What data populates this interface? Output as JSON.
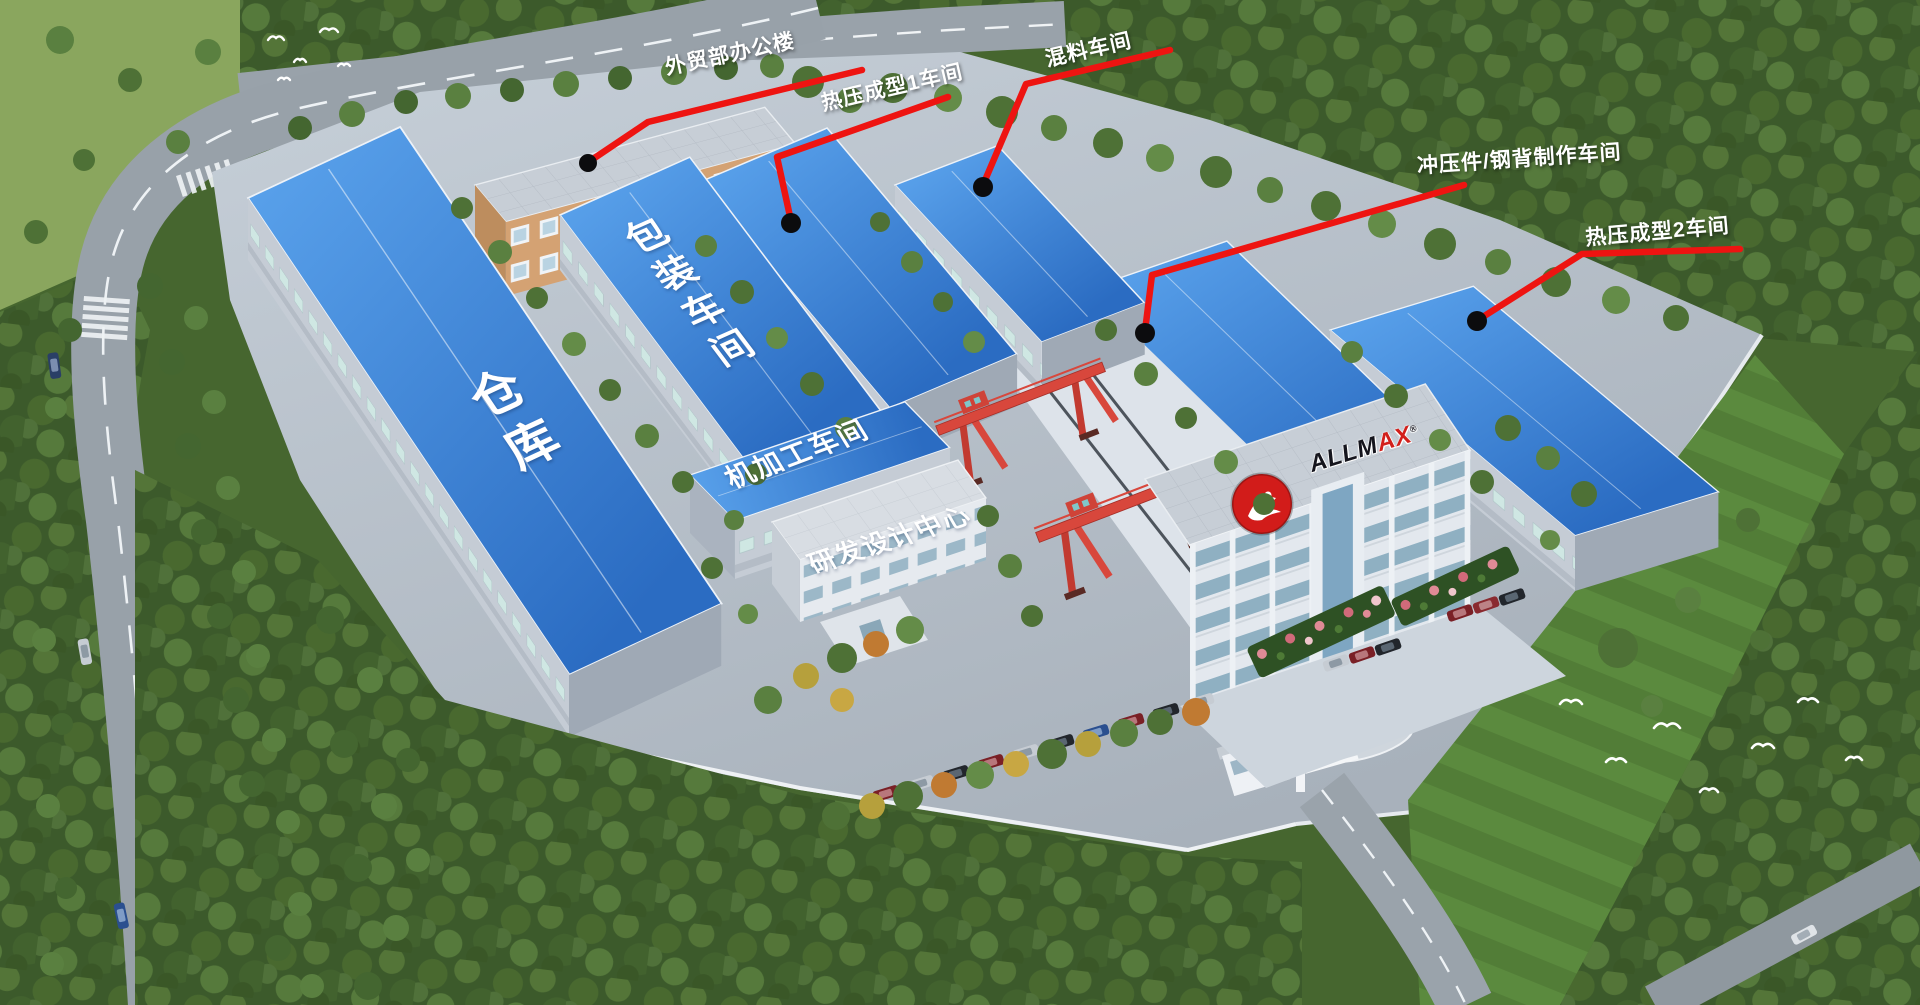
{
  "callouts": [
    {
      "label": "外贸部办公楼"
    },
    {
      "label": "热压成型1车间"
    },
    {
      "label": "混料车间"
    },
    {
      "label": "冲压件/钢背制作车间"
    },
    {
      "label": "热压成型2车间"
    }
  ],
  "roof_labels": {
    "warehouse": "仓库",
    "packaging": "包装车间",
    "machining": "机加工车间",
    "rnd_center": "研发设计中心"
  },
  "logo": {
    "text_primary": "ALLM",
    "text_accent": "AX",
    "registered_mark": "®"
  },
  "colors": {
    "callout_line": "#ee1411",
    "callout_dot": "#0c0c0e",
    "roof_blue": "#3b82d8",
    "crane_red": "#d8473c",
    "logo_red": "#d2201c",
    "label_text": "#ffffff",
    "forest_green": "#3c5a2b",
    "lawn_green": "#527d37"
  },
  "icons": {
    "bird-icon": "~"
  }
}
